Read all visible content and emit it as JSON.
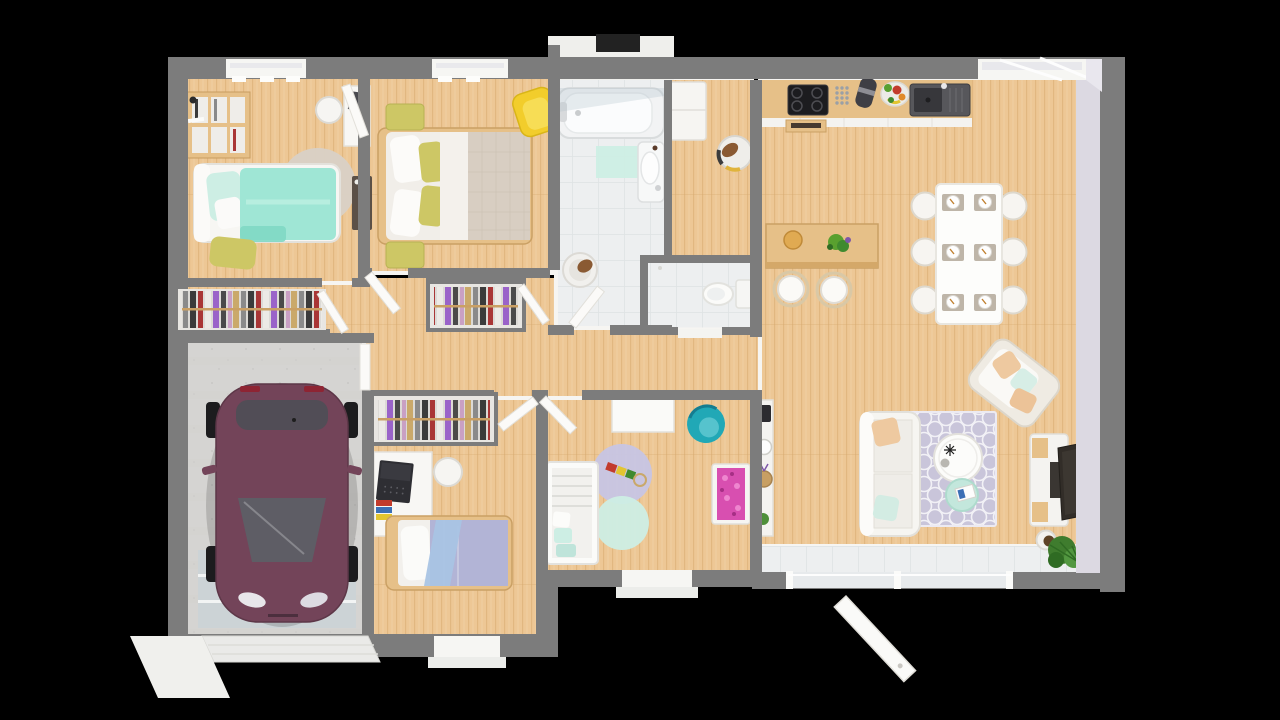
{
  "scene": {
    "type": "3d-render-floorplan-top-view",
    "background": "#000000",
    "description": "Photorealistic top-down 3D floor plan of a single-storey house on a black background",
    "rooms": [
      {
        "id": "bedroom-1",
        "label": "bedroom with teal single bed, bookshelf, desk and closet"
      },
      {
        "id": "master-bedroom",
        "label": "master bedroom with double bed, olive nightstands and yellow armchair"
      },
      {
        "id": "bathroom",
        "label": "bathroom with bathtub, sink, mint mat and laundry basket"
      },
      {
        "id": "utility-room",
        "label": "utility room with cabinet and pet bed"
      },
      {
        "id": "wc",
        "label": "separate toilet room"
      },
      {
        "id": "hallway",
        "label": "hallway with two open closets full of clothes"
      },
      {
        "id": "kitchen-dining-living",
        "label": "open kitchen with island and stools, dining table for six, living room with sofa, rug, coffee table, TV and plants"
      },
      {
        "id": "kids-bedroom",
        "label": "kids bedroom with lavender single bed, desk with laptop and closet"
      },
      {
        "id": "nursery",
        "label": "nursery with crib, round rugs, teal chair and pink dresser"
      },
      {
        "id": "garage",
        "label": "garage with plum colored car and garage door"
      }
    ],
    "furniture": {
      "bedroom-1": [
        "bookshelf",
        "single-bed-teal",
        "olive-pouf",
        "round-rug",
        "desk",
        "chair",
        "dark-dresser",
        "closet-clothes"
      ],
      "master-bedroom": [
        "double-bed",
        "nightstand-top",
        "nightstand-bottom",
        "yellow-armchair"
      ],
      "bathroom": [
        "bathtub",
        "bath-mat",
        "sink",
        "laundry-basket"
      ],
      "utility-room": [
        "cabinet",
        "pet-bed"
      ],
      "wc": [
        "toilet"
      ],
      "kitchen-dining-living": [
        "counter",
        "cooktop",
        "oven",
        "spice-rack",
        "coffee-machine",
        "fruit-bowl",
        "kitchen-sink",
        "island",
        "bar-stools",
        "dining-table",
        "dining-chairs",
        "place-settings",
        "sofa",
        "area-rug",
        "coffee-table",
        "side-table",
        "armchair",
        "tv-stand",
        "tv",
        "potted-plant",
        "console-shelf"
      ],
      "kids-bedroom": [
        "closet-clothes",
        "desk-with-laptop",
        "desk-chair",
        "single-bed-lavender"
      ],
      "nursery": [
        "crib",
        "round-rug-lavender",
        "round-rug-mint",
        "toy-train",
        "wall-table",
        "teal-chair",
        "pink-dresser"
      ],
      "garage": [
        "car",
        "floor-mat",
        "garage-door"
      ]
    }
  },
  "palette": {
    "wall": "#7c7c7c",
    "wallFace": "#f5f4f1",
    "wallLavender": "#dcd9e2",
    "wood": "#edc795",
    "woodLine": "#d6a96e",
    "woodDark": "#e6c088",
    "tile": "#edeff0",
    "tileLine": "#dfe2e4",
    "concrete": "#d5d4d2",
    "mat": "#ccd3d6",
    "white": "#f9f8f6",
    "teal": "#9fe6d5",
    "tealDark": "#7fd8c4",
    "mint": "#cdeee4",
    "olive": "#cdc765",
    "yellow": "#f2cd2b",
    "greige": "#d8cec2",
    "lavender": "#b2b4d6",
    "rugLavender": "#c9c5da",
    "tealChair": "#21a8b6",
    "pink": "#d84fb0",
    "carBody": "#734459",
    "carGlass": "#5d5f66",
    "green": "#4e8f3a",
    "greenDark": "#2f6b23",
    "peach": "#eec9a0",
    "wicker": "#c79f63",
    "blueThrow": "#a9c4e4",
    "dark": "#2e2c2e"
  }
}
